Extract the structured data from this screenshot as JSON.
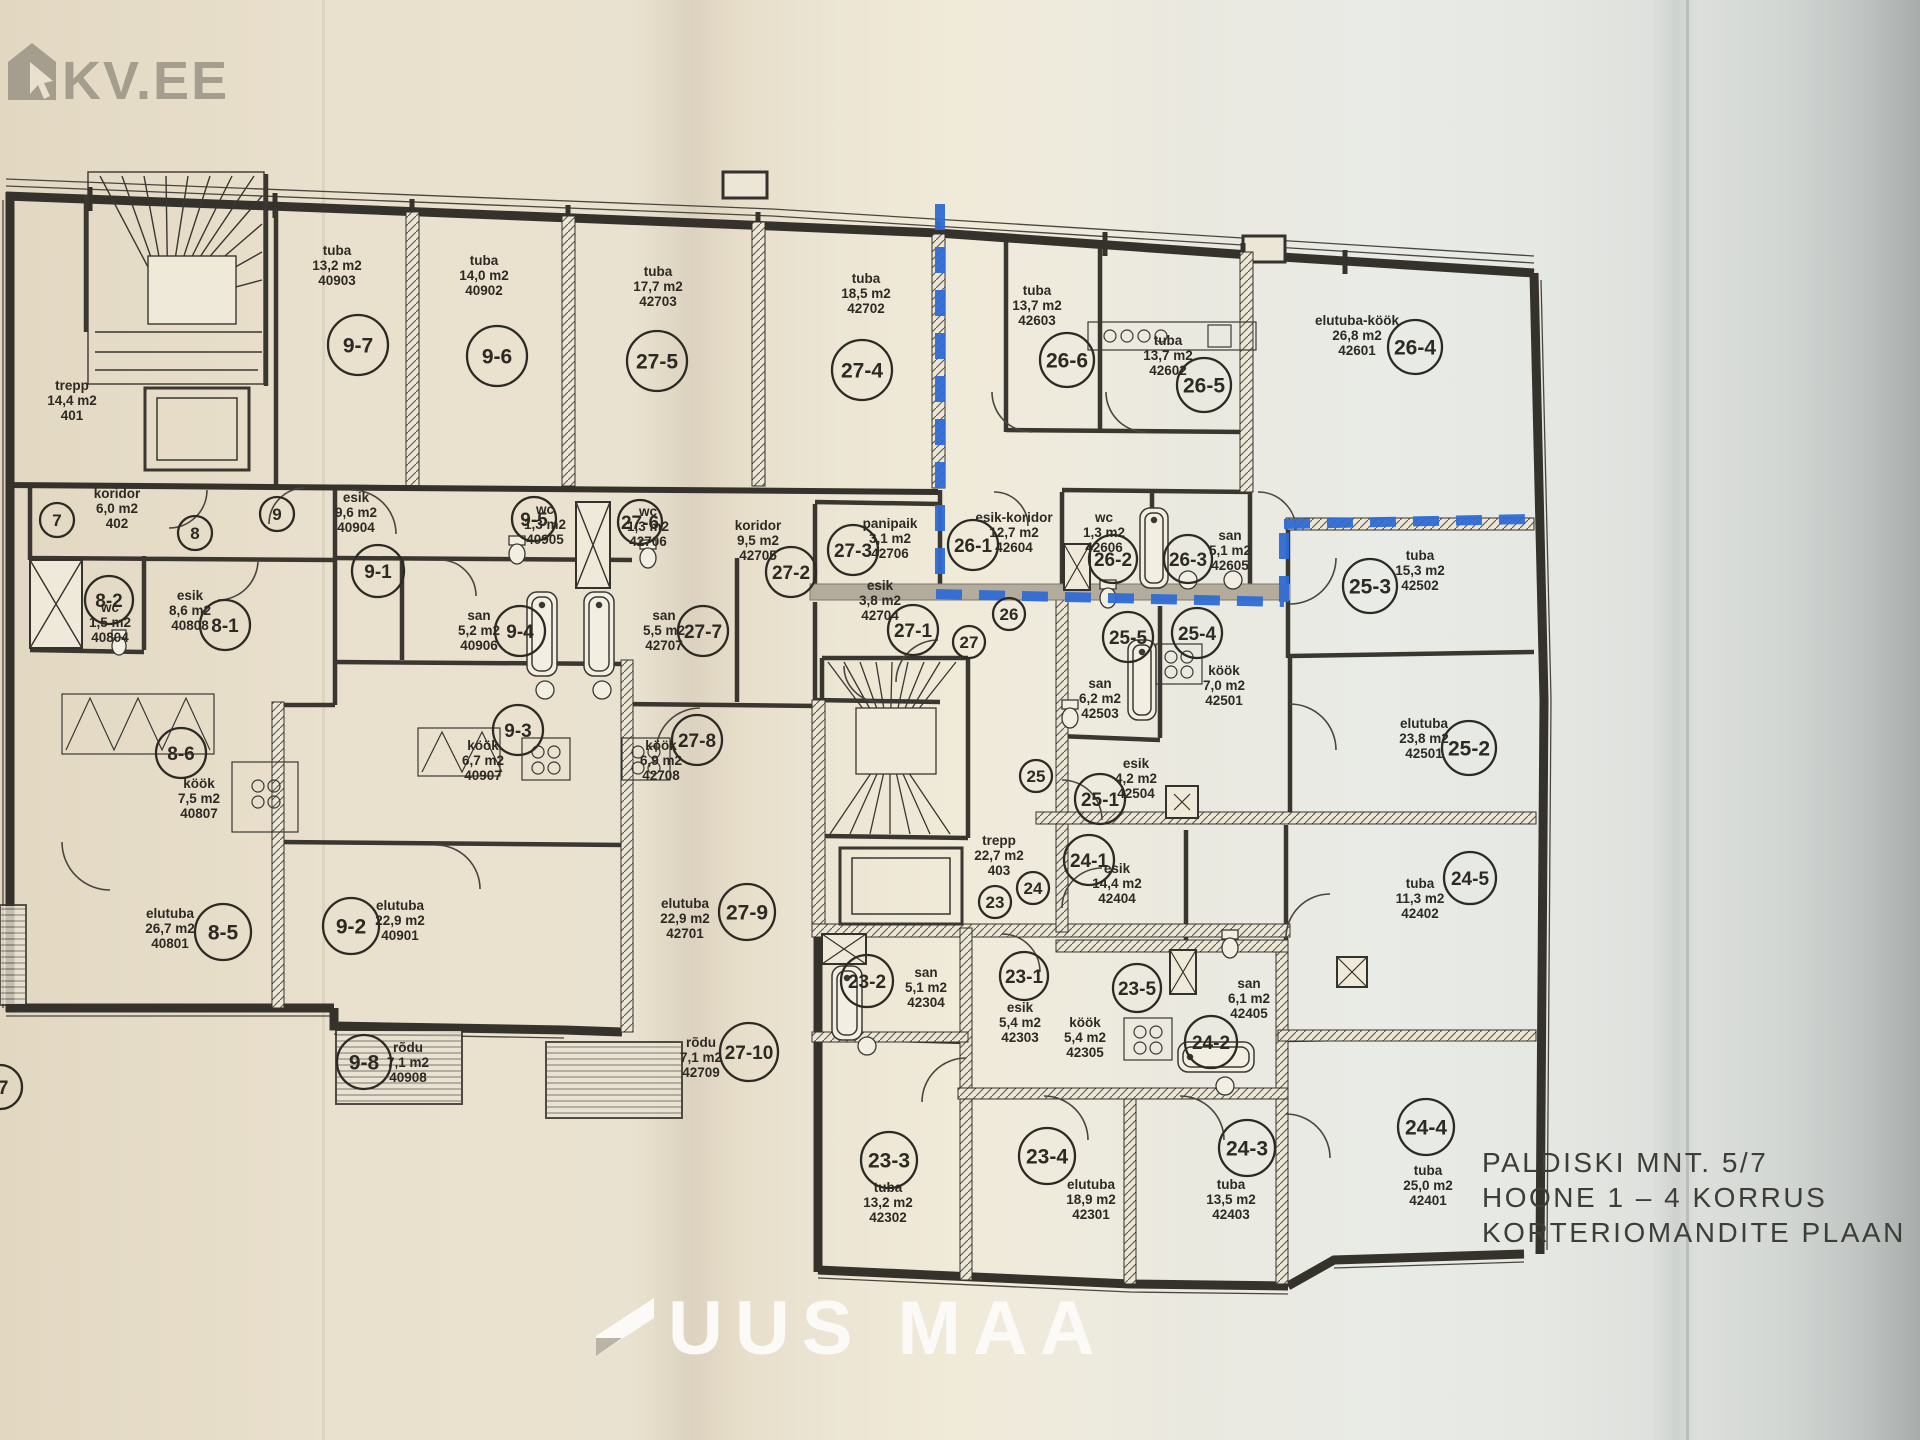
{
  "watermark": {
    "logo_text": "KV.EE",
    "color": "#a59d8e"
  },
  "footer_logo": {
    "text": "UUS MAA",
    "color": "#fbfaf7"
  },
  "title_block": {
    "line1": "PALDISKI MNT. 5/7",
    "line2": "HOONE 1 – 4 KORRUS",
    "line3": "KORTERIOMANDITE PLAAN"
  },
  "colors": {
    "boundary_blue": "#2f6bd4",
    "line": "#35322c",
    "paper_left": "#eae2d0",
    "paper_right": "#e8eae5"
  },
  "units": [
    {
      "id": "9-7",
      "x": 358,
      "y": 345,
      "r": 30
    },
    {
      "id": "9-6",
      "x": 497,
      "y": 356,
      "r": 30
    },
    {
      "id": "27-5",
      "x": 657,
      "y": 361,
      "r": 30
    },
    {
      "id": "27-4",
      "x": 862,
      "y": 370,
      "r": 30
    },
    {
      "id": "26-6",
      "x": 1067,
      "y": 360,
      "r": 27
    },
    {
      "id": "26-5",
      "x": 1204,
      "y": 385,
      "r": 27
    },
    {
      "id": "26-4",
      "x": 1415,
      "y": 347,
      "r": 27
    },
    {
      "id": "7",
      "x": 57,
      "y": 520,
      "r": 17
    },
    {
      "id": "8",
      "x": 195,
      "y": 533,
      "r": 17
    },
    {
      "id": "9",
      "x": 277,
      "y": 514,
      "r": 17
    },
    {
      "id": "9-1",
      "x": 378,
      "y": 571,
      "r": 26
    },
    {
      "id": "8-2",
      "x": 109,
      "y": 600,
      "r": 24
    },
    {
      "id": "8-1",
      "x": 225,
      "y": 625,
      "r": 25
    },
    {
      "id": "9-5",
      "x": 534,
      "y": 519,
      "r": 22
    },
    {
      "id": "27-6",
      "x": 640,
      "y": 522,
      "r": 22
    },
    {
      "id": "9-4",
      "x": 520,
      "y": 631,
      "r": 25
    },
    {
      "id": "27-7",
      "x": 703,
      "y": 631,
      "r": 25
    },
    {
      "id": "9-3",
      "x": 518,
      "y": 730,
      "r": 25
    },
    {
      "id": "27-8",
      "x": 697,
      "y": 740,
      "r": 25
    },
    {
      "id": "27-2",
      "x": 791,
      "y": 572,
      "r": 25
    },
    {
      "id": "27-3",
      "x": 853,
      "y": 550,
      "r": 25
    },
    {
      "id": "27-1",
      "x": 913,
      "y": 630,
      "r": 25
    },
    {
      "id": "27",
      "x": 969,
      "y": 642,
      "r": 16
    },
    {
      "id": "26",
      "x": 1009,
      "y": 614,
      "r": 16
    },
    {
      "id": "26-1",
      "x": 973,
      "y": 545,
      "r": 25
    },
    {
      "id": "26-2",
      "x": 1113,
      "y": 559,
      "r": 24
    },
    {
      "id": "26-3",
      "x": 1188,
      "y": 559,
      "r": 24
    },
    {
      "id": "25-5",
      "x": 1128,
      "y": 637,
      "r": 25
    },
    {
      "id": "25-4",
      "x": 1197,
      "y": 633,
      "r": 25
    },
    {
      "id": "25-3",
      "x": 1370,
      "y": 586,
      "r": 27
    },
    {
      "id": "25-2",
      "x": 1469,
      "y": 748,
      "r": 27
    },
    {
      "id": "25-1",
      "x": 1100,
      "y": 799,
      "r": 25
    },
    {
      "id": "25",
      "x": 1036,
      "y": 776,
      "r": 16
    },
    {
      "id": "24",
      "x": 1033,
      "y": 888,
      "r": 16
    },
    {
      "id": "23",
      "x": 995,
      "y": 902,
      "r": 16
    },
    {
      "id": "24-1",
      "x": 1089,
      "y": 860,
      "r": 25
    },
    {
      "id": "8-6",
      "x": 181,
      "y": 753,
      "r": 25
    },
    {
      "id": "8-5",
      "x": 223,
      "y": 932,
      "r": 28
    },
    {
      "id": "9-2",
      "x": 351,
      "y": 926,
      "r": 28
    },
    {
      "id": "9-8",
      "x": 364,
      "y": 1062,
      "r": 27
    },
    {
      "id": "27-9",
      "x": 747,
      "y": 912,
      "r": 28
    },
    {
      "id": "27-10",
      "x": 749,
      "y": 1052,
      "r": 29
    },
    {
      "id": "23-2",
      "x": 867,
      "y": 981,
      "r": 26
    },
    {
      "id": "23-1",
      "x": 1024,
      "y": 976,
      "r": 24
    },
    {
      "id": "23-5",
      "x": 1137,
      "y": 988,
      "r": 24
    },
    {
      "id": "24-2",
      "x": 1211,
      "y": 1042,
      "r": 26
    },
    {
      "id": "23-3",
      "x": 889,
      "y": 1160,
      "r": 28
    },
    {
      "id": "23-4",
      "x": 1047,
      "y": 1156,
      "r": 28
    },
    {
      "id": "24-3",
      "x": 1247,
      "y": 1148,
      "r": 28
    },
    {
      "id": "24-4",
      "x": 1426,
      "y": 1127,
      "r": 28
    },
    {
      "id": "24-5",
      "x": 1470,
      "y": 878,
      "r": 26
    },
    {
      "id": "-7",
      "x": 0,
      "y": 1087,
      "r": 22
    }
  ],
  "rooms": [
    {
      "name": "trepp",
      "area": "14,4 m2",
      "num": "401",
      "x": 72,
      "y": 390
    },
    {
      "name": "tuba",
      "area": "13,2 m2",
      "num": "40903",
      "x": 337,
      "y": 255
    },
    {
      "name": "tuba",
      "area": "14,0 m2",
      "num": "40902",
      "x": 484,
      "y": 265
    },
    {
      "name": "tuba",
      "area": "17,7 m2",
      "num": "42703",
      "x": 658,
      "y": 276
    },
    {
      "name": "tuba",
      "area": "18,5 m2",
      "num": "42702",
      "x": 866,
      "y": 283
    },
    {
      "name": "tuba",
      "area": "13,7 m2",
      "num": "42603",
      "x": 1037,
      "y": 295
    },
    {
      "name": "tuba",
      "area": "13,7 m2",
      "num": "42602",
      "x": 1168,
      "y": 345
    },
    {
      "name": "elutuba-köök",
      "area": "26,8 m2",
      "num": "42601",
      "x": 1357,
      "y": 325
    },
    {
      "name": "koridor",
      "area": "6,0 m2",
      "num": "402",
      "x": 117,
      "y": 498
    },
    {
      "name": "esik",
      "area": "9,6 m2",
      "num": "40904",
      "x": 356,
      "y": 502
    },
    {
      "name": "wc",
      "area": "1,3 m2",
      "num": "40905",
      "x": 545,
      "y": 514
    },
    {
      "name": "wc",
      "area": "1,3 m2",
      "num": "42706",
      "x": 648,
      "y": 516
    },
    {
      "name": "san",
      "area": "5,2 m2",
      "num": "40906",
      "x": 479,
      "y": 620
    },
    {
      "name": "san",
      "area": "5,5 m2",
      "num": "42707",
      "x": 664,
      "y": 620
    },
    {
      "name": "köök",
      "area": "6,7 m2",
      "num": "40907",
      "x": 483,
      "y": 750
    },
    {
      "name": "köök",
      "area": "6,9 m2",
      "num": "42708",
      "x": 661,
      "y": 750
    },
    {
      "name": "koridor",
      "area": "9,5 m2",
      "num": "42705",
      "x": 758,
      "y": 530
    },
    {
      "name": "panipaik",
      "area": "3,1 m2",
      "num": "42706",
      "x": 890,
      "y": 528
    },
    {
      "name": "esik",
      "area": "3,8 m2",
      "num": "42704",
      "x": 880,
      "y": 590
    },
    {
      "name": "esik-koridor",
      "area": "12,7 m2",
      "num": "42604",
      "x": 1014,
      "y": 522
    },
    {
      "name": "wc",
      "area": "1,3 m2",
      "num": "42606",
      "x": 1104,
      "y": 522
    },
    {
      "name": "san",
      "area": "5,1 m2",
      "num": "42605",
      "x": 1230,
      "y": 540
    },
    {
      "name": "tuba",
      "area": "15,3 m2",
      "num": "42502",
      "x": 1420,
      "y": 560
    },
    {
      "name": "san",
      "area": "6,2 m2",
      "num": "42503",
      "x": 1100,
      "y": 688
    },
    {
      "name": "köök",
      "area": "7,0 m2",
      "num": "42501",
      "x": 1224,
      "y": 675
    },
    {
      "name": "esik",
      "area": "4,2 m2",
      "num": "42504",
      "x": 1136,
      "y": 768
    },
    {
      "name": "elutuba",
      "area": "23,8 m2",
      "num": "42501",
      "x": 1424,
      "y": 728
    },
    {
      "name": "trepp",
      "area": "22,7 m2",
      "num": "403",
      "x": 999,
      "y": 845
    },
    {
      "name": "esik",
      "area": "14,4 m2",
      "num": "42404",
      "x": 1117,
      "y": 873
    },
    {
      "name": "wc",
      "area": "1,5 m2",
      "num": "40804",
      "x": 110,
      "y": 612
    },
    {
      "name": "esik",
      "area": "8,6 m2",
      "num": "40808",
      "x": 190,
      "y": 600
    },
    {
      "name": "köök",
      "area": "7,5 m2",
      "num": "40807",
      "x": 199,
      "y": 788
    },
    {
      "name": "elutuba",
      "area": "26,7 m2",
      "num": "40801",
      "x": 170,
      "y": 918
    },
    {
      "name": "elutuba",
      "area": "22,9 m2",
      "num": "40901",
      "x": 400,
      "y": 910
    },
    {
      "name": "rõdu",
      "area": "7,1 m2",
      "num": "40908",
      "x": 408,
      "y": 1052
    },
    {
      "name": "elutuba",
      "area": "22,9 m2",
      "num": "42701",
      "x": 685,
      "y": 908
    },
    {
      "name": "rõdu",
      "area": "7,1 m2",
      "num": "42709",
      "x": 701,
      "y": 1047
    },
    {
      "name": "san",
      "area": "5,1 m2",
      "num": "42304",
      "x": 926,
      "y": 977
    },
    {
      "name": "esik",
      "area": "5,4 m2",
      "num": "42303",
      "x": 1020,
      "y": 1012
    },
    {
      "name": "köök",
      "area": "5,4 m2",
      "num": "42305",
      "x": 1085,
      "y": 1027
    },
    {
      "name": "san",
      "area": "6,1 m2",
      "num": "42405",
      "x": 1249,
      "y": 988
    },
    {
      "name": "tuba",
      "area": "13,2 m2",
      "num": "42302",
      "x": 888,
      "y": 1192
    },
    {
      "name": "elutuba",
      "area": "18,9 m2",
      "num": "42301",
      "x": 1091,
      "y": 1189
    },
    {
      "name": "tuba",
      "area": "13,5 m2",
      "num": "42403",
      "x": 1231,
      "y": 1189
    },
    {
      "name": "tuba",
      "area": "25,0 m2",
      "num": "42401",
      "x": 1428,
      "y": 1175
    },
    {
      "name": "tuba",
      "area": "11,3 m2",
      "num": "42402",
      "x": 1420,
      "y": 888
    }
  ]
}
